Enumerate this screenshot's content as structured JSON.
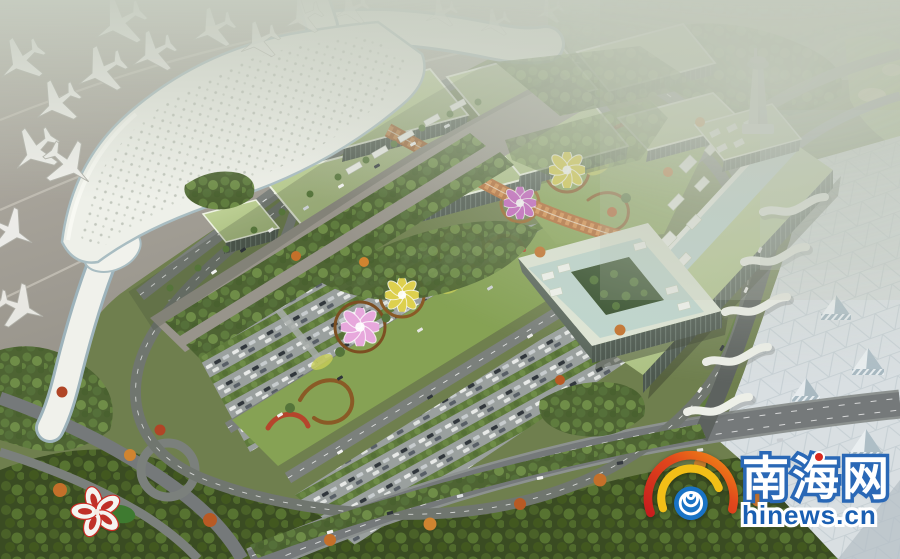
{
  "watermark": {
    "site_name": "南海网",
    "site_url": "hinews.cn",
    "logo_name": "hinews-spiral-logo",
    "colors": {
      "arc_red": "#c81d1d",
      "arc_orange": "#f08f15",
      "arc_yellow": "#f2bf17",
      "spiral_blue": "#1973c5",
      "cn_text_fill": "#ffffff",
      "cn_text_outline": "#2a68b6",
      "url_text_fill": "#1a5fb2",
      "accent_dot_red": "#d8281e"
    }
  },
  "scene": {
    "description": "Aerial architectural rendering of an airport complex: white curved terminal with parked airplanes, green-roofed exhibition halls linked by an orange canopy walkway, lotus and hibiscus flower sculptures, ornamental gardens, tree-lined parking lots, looping highways, a control tower, a glass courtyard office block and a geometric-roofed transport center",
    "elements": [
      "airport-terminal",
      "parked-airplanes",
      "green-roof-halls",
      "orange-canopy-walkway",
      "lotus-flower-sculptures",
      "hibiscus-flower-sculpture",
      "ornamental-garden-median",
      "parking-lots",
      "highway-interchange",
      "control-tower",
      "courtyard-office-building",
      "long-green-roof-building",
      "geometric-roof-transport-center"
    ]
  }
}
